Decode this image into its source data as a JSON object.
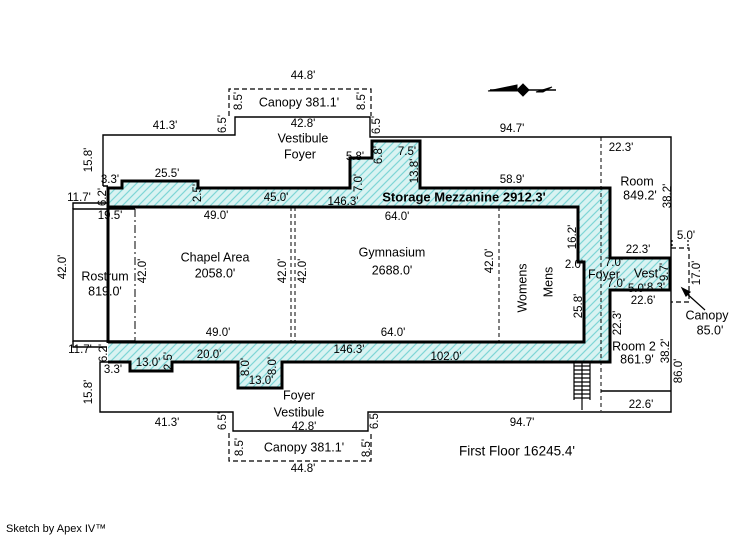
{
  "footer": {
    "credit": "Sketch by Apex IV™"
  },
  "colors": {
    "background": "#ffffff",
    "wall": "#000000",
    "hatch_fill": "#d9f3f2",
    "hatch_stripe": "#7fd6d6"
  },
  "plan": {
    "title": "First Floor",
    "total_area": "16245.4'",
    "rooms": [
      {
        "name": "Storage Mezzanine",
        "area": "2912.3'"
      },
      {
        "name": "Chapel Area",
        "area": "2058.0'"
      },
      {
        "name": "Gymnasium",
        "area": "2688.0'"
      },
      {
        "name": "Rostrum",
        "area": "819.0'"
      },
      {
        "name": "Room",
        "area": "849.2'"
      },
      {
        "name": "Room 2",
        "area": "861.9'"
      },
      {
        "name": "Canopy (top)",
        "area": "381.1'"
      },
      {
        "name": "Canopy (bottom)",
        "area": "381.1'"
      },
      {
        "name": "Canopy (right)",
        "area": "85.0'"
      },
      {
        "name": "Vestibule Foyer",
        "area": "42.8'"
      },
      {
        "name": "Foyer",
        "area": ""
      },
      {
        "name": "Vest",
        "area": ""
      },
      {
        "name": "Womens",
        "area": ""
      },
      {
        "name": "Mens",
        "area": ""
      }
    ]
  },
  "labels": [
    {
      "t": "44.8'",
      "x": 303,
      "y": 76
    },
    {
      "t": "Canopy  381.1'",
      "x": 299,
      "y": 103,
      "s": 12.5,
      "n": "room-label"
    },
    {
      "t": "8.5'",
      "x": 239,
      "y": 101,
      "r": -90
    },
    {
      "t": "8.5'",
      "x": 362,
      "y": 101,
      "r": -90
    },
    {
      "t": "41.3'",
      "x": 165,
      "y": 126
    },
    {
      "t": "6.5'",
      "x": 223,
      "y": 124,
      "r": -90
    },
    {
      "t": "6.5'",
      "x": 377,
      "y": 125,
      "r": -90
    },
    {
      "t": "42.8'",
      "x": 303,
      "y": 124
    },
    {
      "t": "Vestibule",
      "x": 303,
      "y": 139,
      "s": 12.5,
      "n": "room-label"
    },
    {
      "t": "Foyer",
      "x": 300,
      "y": 155,
      "s": 12.5,
      "n": "room-label"
    },
    {
      "t": "94.7'",
      "x": 512,
      "y": 129
    },
    {
      "t": "15.8'",
      "x": 89,
      "y": 160,
      "r": -90
    },
    {
      "t": "22.3'",
      "x": 621,
      "y": 148
    },
    {
      "t": "3.3'",
      "x": 110,
      "y": 180
    },
    {
      "t": "25.5'",
      "x": 167,
      "y": 174
    },
    {
      "t": "5.8'",
      "x": 355,
      "y": 157
    },
    {
      "t": "6.8'",
      "x": 379,
      "y": 155,
      "r": -90
    },
    {
      "t": "7.5'",
      "x": 407,
      "y": 152
    },
    {
      "t": "7.0'",
      "x": 359,
      "y": 183,
      "r": -90
    },
    {
      "t": "13.8'",
      "x": 415,
      "y": 171,
      "r": -90
    },
    {
      "t": "58.9'",
      "x": 512,
      "y": 180
    },
    {
      "t": "Room",
      "x": 637,
      "y": 182,
      "s": 12.5,
      "n": "room-label"
    },
    {
      "t": "849.2'",
      "x": 640,
      "y": 196,
      "s": 12.5,
      "n": "room-label"
    },
    {
      "t": "38.2'",
      "x": 668,
      "y": 196,
      "r": -90
    },
    {
      "t": "11.7'",
      "x": 79,
      "y": 198
    },
    {
      "t": "6.2'",
      "x": 103,
      "y": 197,
      "r": -90
    },
    {
      "t": "2.5'",
      "x": 198,
      "y": 193,
      "r": -90
    },
    {
      "t": "45.0'",
      "x": 276,
      "y": 198
    },
    {
      "t": "146.3'",
      "x": 343,
      "y": 202
    },
    {
      "t": "Storage Mezzanine 2912.3'",
      "x": 464,
      "y": 198,
      "s": 13,
      "b": true,
      "n": "room-label"
    },
    {
      "t": "19.5'",
      "x": 110,
      "y": 216
    },
    {
      "t": "49.0'",
      "x": 216,
      "y": 216
    },
    {
      "t": "64.0'",
      "x": 397,
      "y": 217
    },
    {
      "t": "16.2'",
      "x": 573,
      "y": 237,
      "r": -90
    },
    {
      "t": "42.0'",
      "x": 63,
      "y": 267,
      "r": -90
    },
    {
      "t": "Rostrum",
      "x": 105,
      "y": 277,
      "s": 12.5,
      "n": "room-label"
    },
    {
      "t": "819.0'",
      "x": 105,
      "y": 292,
      "s": 12.5,
      "n": "room-label"
    },
    {
      "t": "42.0'",
      "x": 143,
      "y": 271,
      "r": -90
    },
    {
      "t": "Chapel Area",
      "x": 215,
      "y": 258,
      "s": 12.5,
      "n": "room-label"
    },
    {
      "t": "2058.0'",
      "x": 215,
      "y": 274,
      "s": 12.5,
      "n": "room-label"
    },
    {
      "t": "42.0'",
      "x": 283,
      "y": 271,
      "r": -90
    },
    {
      "t": "42.0'",
      "x": 303,
      "y": 271,
      "r": -90
    },
    {
      "t": "Gymnasium",
      "x": 392,
      "y": 253,
      "s": 12.5,
      "n": "room-label"
    },
    {
      "t": "2688.0'",
      "x": 392,
      "y": 271,
      "s": 12.5,
      "n": "room-label"
    },
    {
      "t": "42.0'",
      "x": 490,
      "y": 261,
      "r": -90
    },
    {
      "t": "Womens",
      "x": 523,
      "y": 288,
      "r": -90,
      "s": 12.5,
      "n": "room-label"
    },
    {
      "t": "Mens",
      "x": 549,
      "y": 282,
      "r": -90,
      "s": 12.5,
      "n": "room-label"
    },
    {
      "t": "2.0'",
      "x": 574,
      "y": 265
    },
    {
      "t": "22.3'",
      "x": 638,
      "y": 250
    },
    {
      "t": "7.0'",
      "x": 614,
      "y": 263
    },
    {
      "t": "Foyer",
      "x": 604,
      "y": 275,
      "s": 12.5,
      "n": "room-label"
    },
    {
      "t": "Vest",
      "x": 646,
      "y": 274,
      "s": 12.5,
      "n": "room-label"
    },
    {
      "t": "9.7'",
      "x": 665,
      "y": 272,
      "r": -90
    },
    {
      "t": "7.0'",
      "x": 616,
      "y": 284
    },
    {
      "t": "5.0'",
      "x": 637,
      "y": 289
    },
    {
      "t": "8.3'",
      "x": 656,
      "y": 288
    },
    {
      "t": "22.6'",
      "x": 643,
      "y": 301
    },
    {
      "t": "25.8'",
      "x": 579,
      "y": 306,
      "r": -90
    },
    {
      "t": "5.0'",
      "x": 686,
      "y": 236
    },
    {
      "t": "17.0'",
      "x": 697,
      "y": 273,
      "r": -90
    },
    {
      "t": "Canopy",
      "x": 707,
      "y": 316,
      "s": 12.5,
      "n": "room-label"
    },
    {
      "t": "85.0'",
      "x": 710,
      "y": 331,
      "s": 12.5,
      "n": "room-label"
    },
    {
      "t": "22.3'",
      "x": 618,
      "y": 323,
      "r": -90
    },
    {
      "t": "Room 2",
      "x": 634,
      "y": 347,
      "s": 12.5,
      "n": "room-label"
    },
    {
      "t": "861.9'",
      "x": 637,
      "y": 360,
      "s": 12.5,
      "n": "room-label"
    },
    {
      "t": "38.2'",
      "x": 666,
      "y": 351,
      "r": -90
    },
    {
      "t": "86.0'",
      "x": 679,
      "y": 371,
      "r": -90
    },
    {
      "t": "49.0'",
      "x": 218,
      "y": 333
    },
    {
      "t": "64.0'",
      "x": 393,
      "y": 333
    },
    {
      "t": "146.3'",
      "x": 349,
      "y": 350
    },
    {
      "t": "102.0'",
      "x": 446,
      "y": 357
    },
    {
      "t": "11.7'",
      "x": 80,
      "y": 350
    },
    {
      "t": "6.2'",
      "x": 104,
      "y": 353,
      "r": -90
    },
    {
      "t": "3.3'",
      "x": 113,
      "y": 370
    },
    {
      "t": "13.0'",
      "x": 148,
      "y": 363
    },
    {
      "t": "2.5'",
      "x": 169,
      "y": 361,
      "r": -90
    },
    {
      "t": "20.0'",
      "x": 209,
      "y": 355
    },
    {
      "t": "8.0'",
      "x": 246,
      "y": 367,
      "r": -90
    },
    {
      "t": "8.0'",
      "x": 273,
      "y": 366,
      "r": -90
    },
    {
      "t": "13.0'",
      "x": 261,
      "y": 381
    },
    {
      "t": "15.8'",
      "x": 89,
      "y": 392,
      "r": -90
    },
    {
      "t": "Foyer",
      "x": 299,
      "y": 396,
      "s": 12.5,
      "n": "room-label"
    },
    {
      "t": "Vestibule",
      "x": 299,
      "y": 413,
      "s": 12.5,
      "n": "room-label"
    },
    {
      "t": "42.8'",
      "x": 304,
      "y": 427
    },
    {
      "t": "41.3'",
      "x": 167,
      "y": 423
    },
    {
      "t": "6.5'",
      "x": 223,
      "y": 421,
      "r": -90
    },
    {
      "t": "6.5'",
      "x": 375,
      "y": 420,
      "r": -90
    },
    {
      "t": "22.6'",
      "x": 641,
      "y": 405
    },
    {
      "t": "94.7'",
      "x": 522,
      "y": 423
    },
    {
      "t": "8.5'",
      "x": 240,
      "y": 447,
      "r": -90
    },
    {
      "t": "Canopy  381.1'",
      "x": 304,
      "y": 448,
      "s": 12.5,
      "n": "room-label"
    },
    {
      "t": "8.5'",
      "x": 367,
      "y": 448,
      "r": -90
    },
    {
      "t": "44.8'",
      "x": 303,
      "y": 469
    },
    {
      "t": "First Floor  16245.4'",
      "x": 517,
      "y": 452,
      "s": 13.5,
      "n": "summary-label"
    }
  ]
}
